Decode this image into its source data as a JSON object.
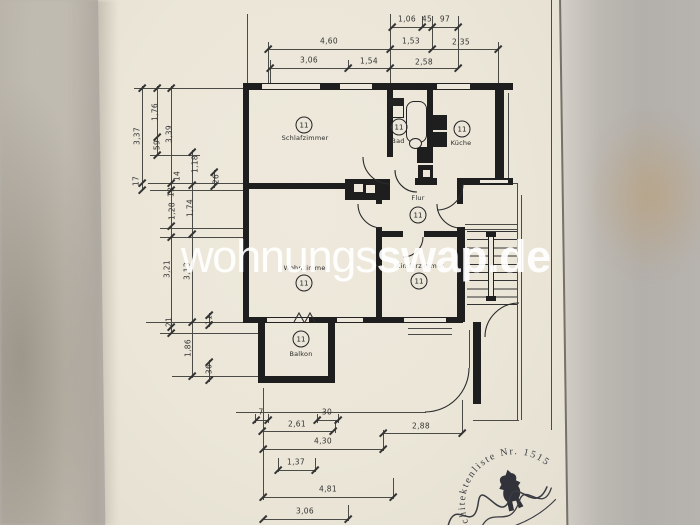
{
  "watermark": {
    "prefix": "wohnungs",
    "suffix": "swap.de"
  },
  "rooms": {
    "schlafzimmer": {
      "label": "Schlafzimmer",
      "number": "11"
    },
    "bad": {
      "label": "Bad",
      "number": "11"
    },
    "kueche": {
      "label": "Küche",
      "number": "11"
    },
    "flur": {
      "label": "Flur",
      "number": "11"
    },
    "wohnzimmer": {
      "label": "Wohnzimmer",
      "number": "11"
    },
    "zimmer2": {
      "label": "Kinderzimmer",
      "number": "11"
    },
    "balkon": {
      "label": "Balkon",
      "number": "11"
    }
  },
  "dimensions": {
    "top_row1": [
      "1,06",
      "45",
      "97"
    ],
    "top_row2": [
      "4,60",
      "1,53",
      "2,35"
    ],
    "top_row3": [
      "3,06",
      "1,54",
      "2,58"
    ],
    "left": [
      "3,37",
      "1,76",
      "59",
      "3,39",
      "17",
      "14",
      "13",
      "1,18",
      "26",
      "1,28",
      "1,74",
      "3,21",
      "3,13",
      "21",
      "11",
      "1,86",
      "36"
    ],
    "bottom": {
      "d7": "7",
      "d30": "30",
      "d261": "2,61",
      "d288": "2,88",
      "d430": "4,30",
      "d137": "1,37",
      "d481": "4,81",
      "d306": "3,06"
    }
  },
  "stamp": {
    "arc_text": "Architektenliste Nr. 1515",
    "icon": "berlin-bear"
  }
}
